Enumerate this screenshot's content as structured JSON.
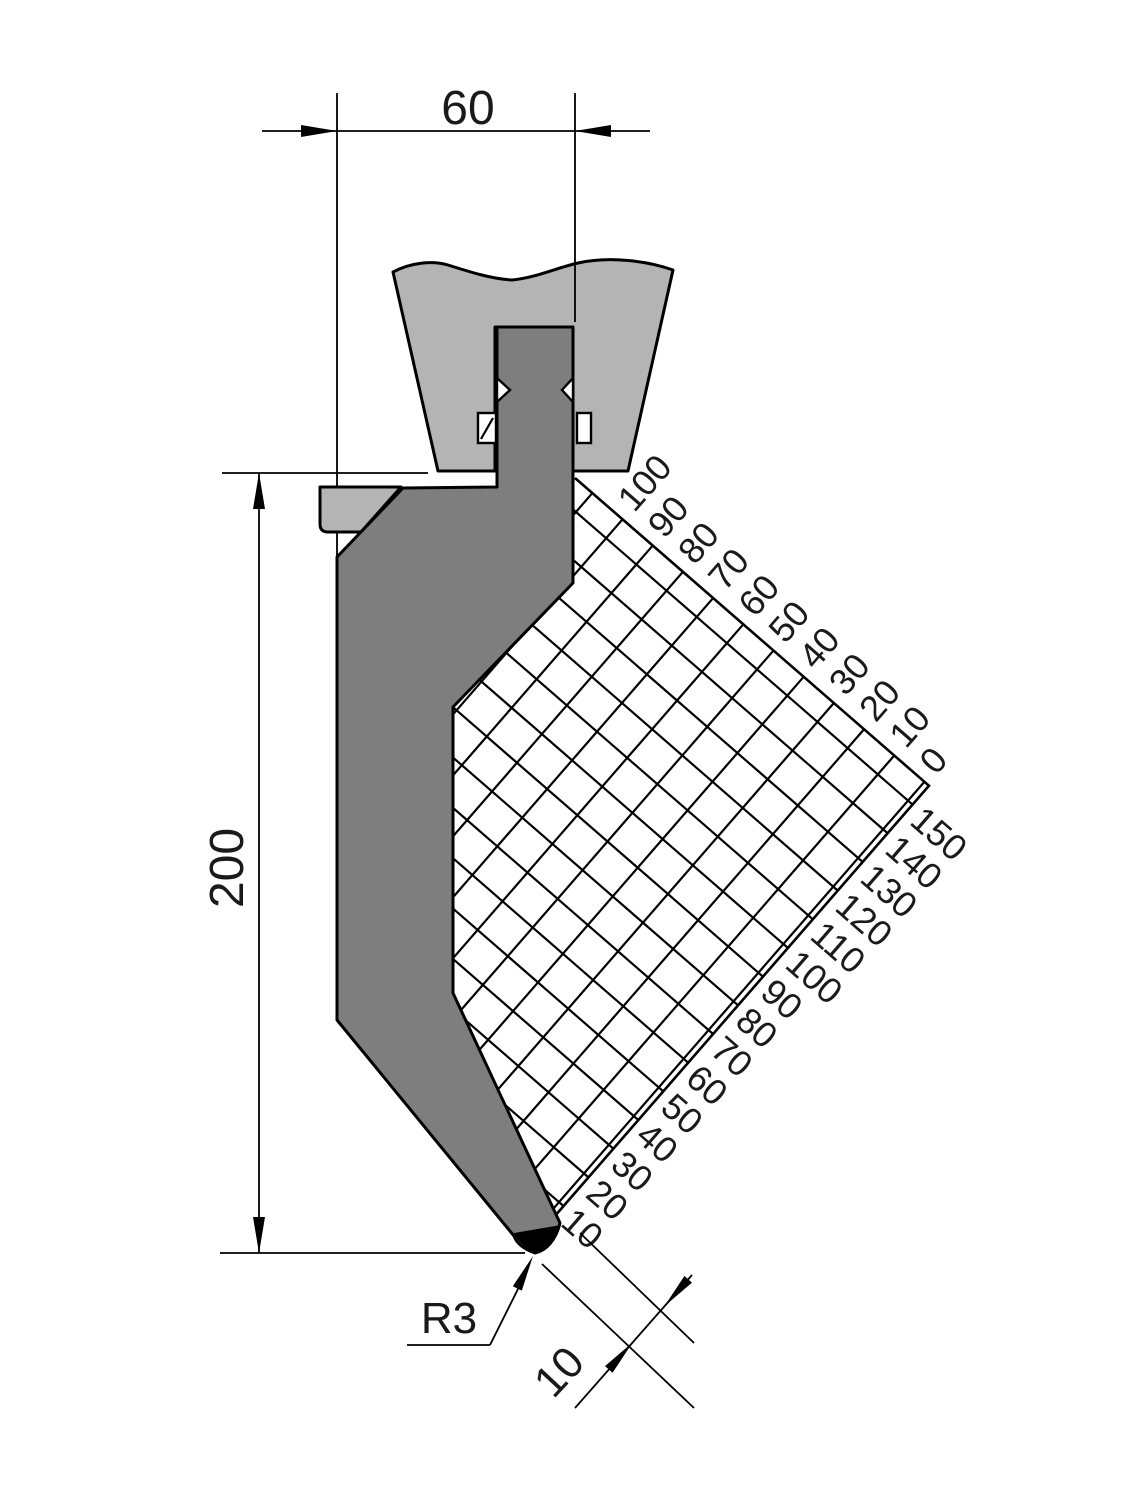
{
  "drawing": {
    "dimensions": {
      "width": "60",
      "height": "200",
      "tip_radius": "R3",
      "tip_offset": "10"
    },
    "grid": {
      "top_axis_labels": [
        "100",
        "90",
        "80",
        "70",
        "60",
        "50",
        "40",
        "30",
        "20",
        "10",
        "0"
      ],
      "right_axis_labels": [
        "150",
        "140",
        "130",
        "120",
        "110",
        "100",
        "90",
        "80",
        "70",
        "60",
        "50",
        "40",
        "30",
        "20",
        "10"
      ]
    },
    "colors": {
      "punch_fill": "#7e7e7e",
      "clamp_fill": "#b4b4b4",
      "tip_fill": "#000000",
      "line": "#000000",
      "label_color": "#1a1a1a",
      "background": "#ffffff"
    }
  }
}
